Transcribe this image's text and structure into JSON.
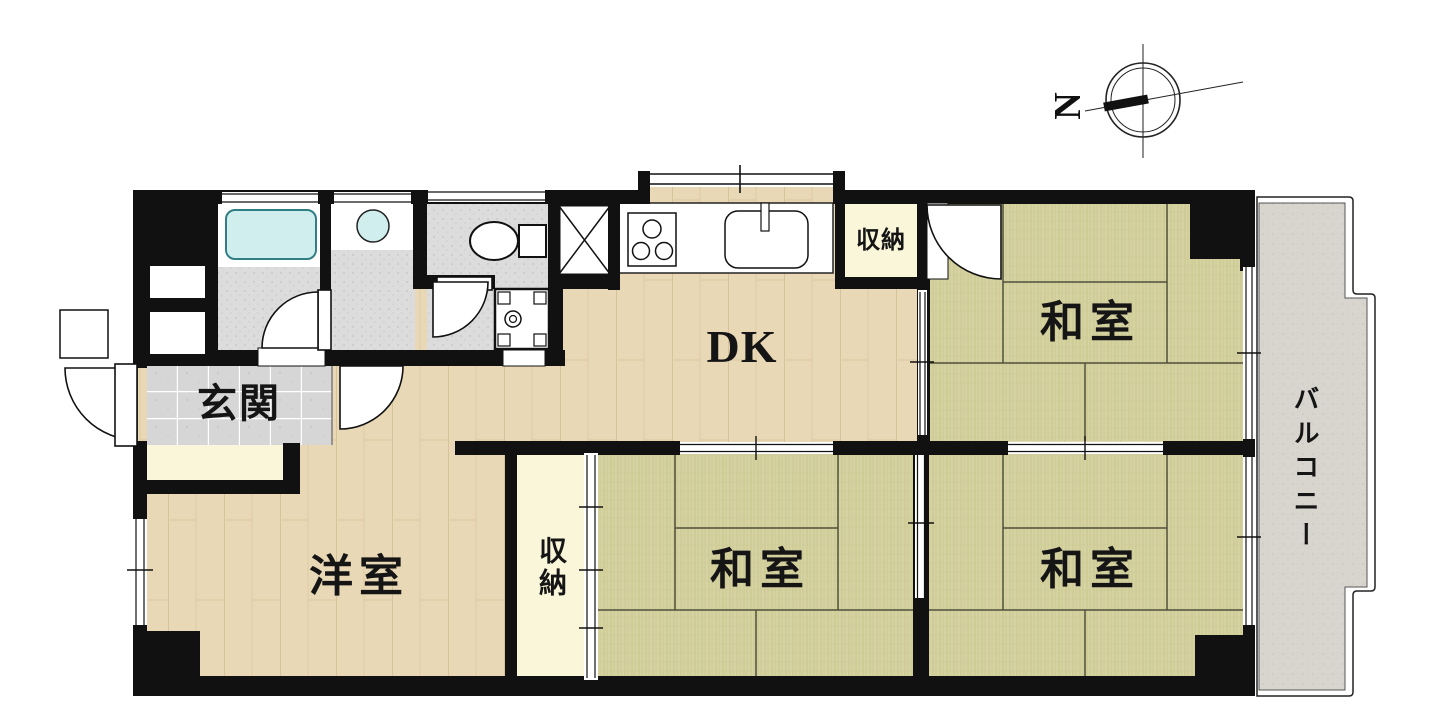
{
  "compass": {
    "north_label": "N"
  },
  "rooms": {
    "entrance": {
      "label": "玄関"
    },
    "dining_kitchen": {
      "label": "DK"
    },
    "storage_north": {
      "label": "収納"
    },
    "japanese_room_northeast": {
      "label": "和室"
    },
    "western_room": {
      "label": "洋室"
    },
    "storage_center": {
      "label": "収納"
    },
    "japanese_room_south_center": {
      "label": "和室"
    },
    "japanese_room_southeast": {
      "label": "和室"
    },
    "balcony": {
      "label": "バルコニー"
    }
  },
  "palette": {
    "wall": "#111111",
    "wood_floor": "#e9d8b5",
    "wood_line": "#d3bd92",
    "tatami": "#d6d3a2",
    "tatami_stripe": "#c9c58d",
    "tatami_line": "#50503a",
    "entrance_tile": "#d7d7d7",
    "utility_floor": "#dcdcdc",
    "closet_cream": "#faf6da",
    "balcony_gray": "#d8d5cf",
    "bathtub": "#cfeeed",
    "background": "#ffffff"
  }
}
